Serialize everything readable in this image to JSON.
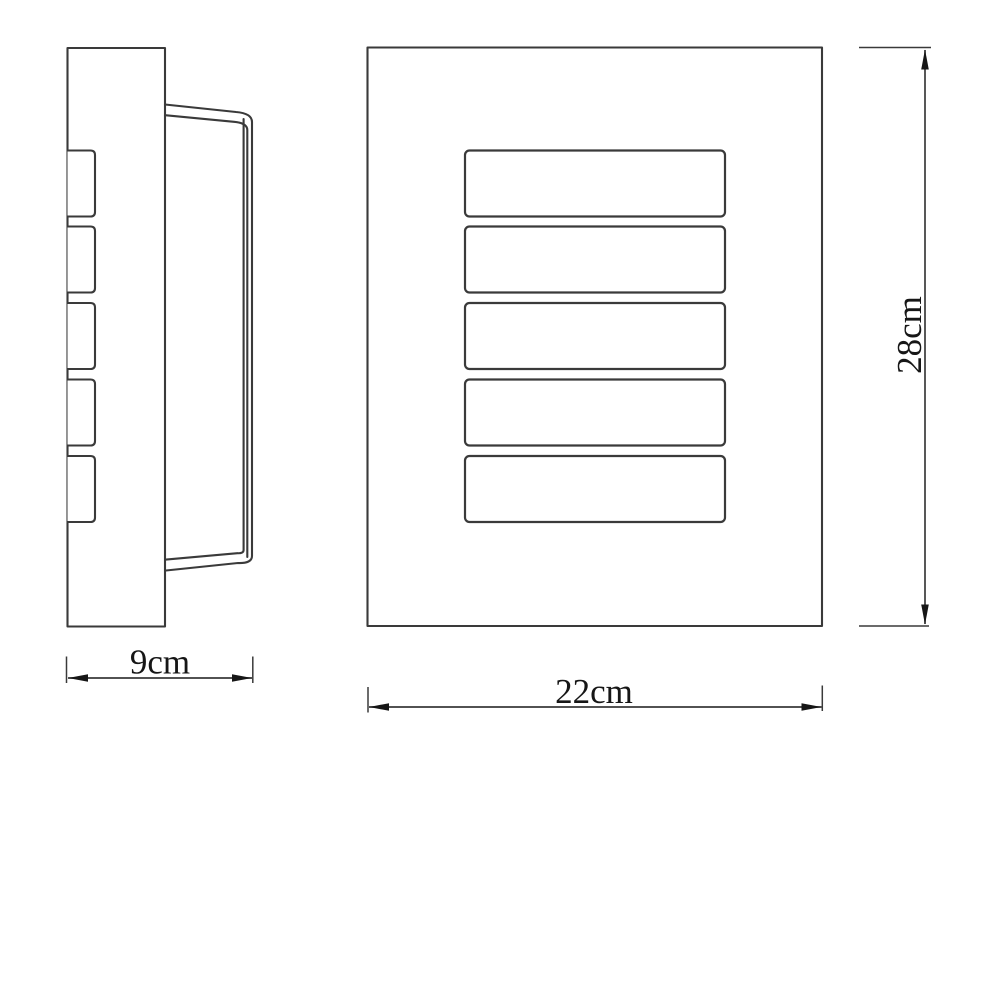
{
  "colors": {
    "background": "#ffffff",
    "line": "#3a3a3a",
    "ink": "#161616"
  },
  "side_view": {
    "slat_count": 5
  },
  "front_view": {
    "slot_count": 5
  },
  "dimensions": {
    "side_width": {
      "label": "9cm"
    },
    "front_width": {
      "label": "22cm"
    },
    "front_height": {
      "label": "28cm"
    }
  }
}
